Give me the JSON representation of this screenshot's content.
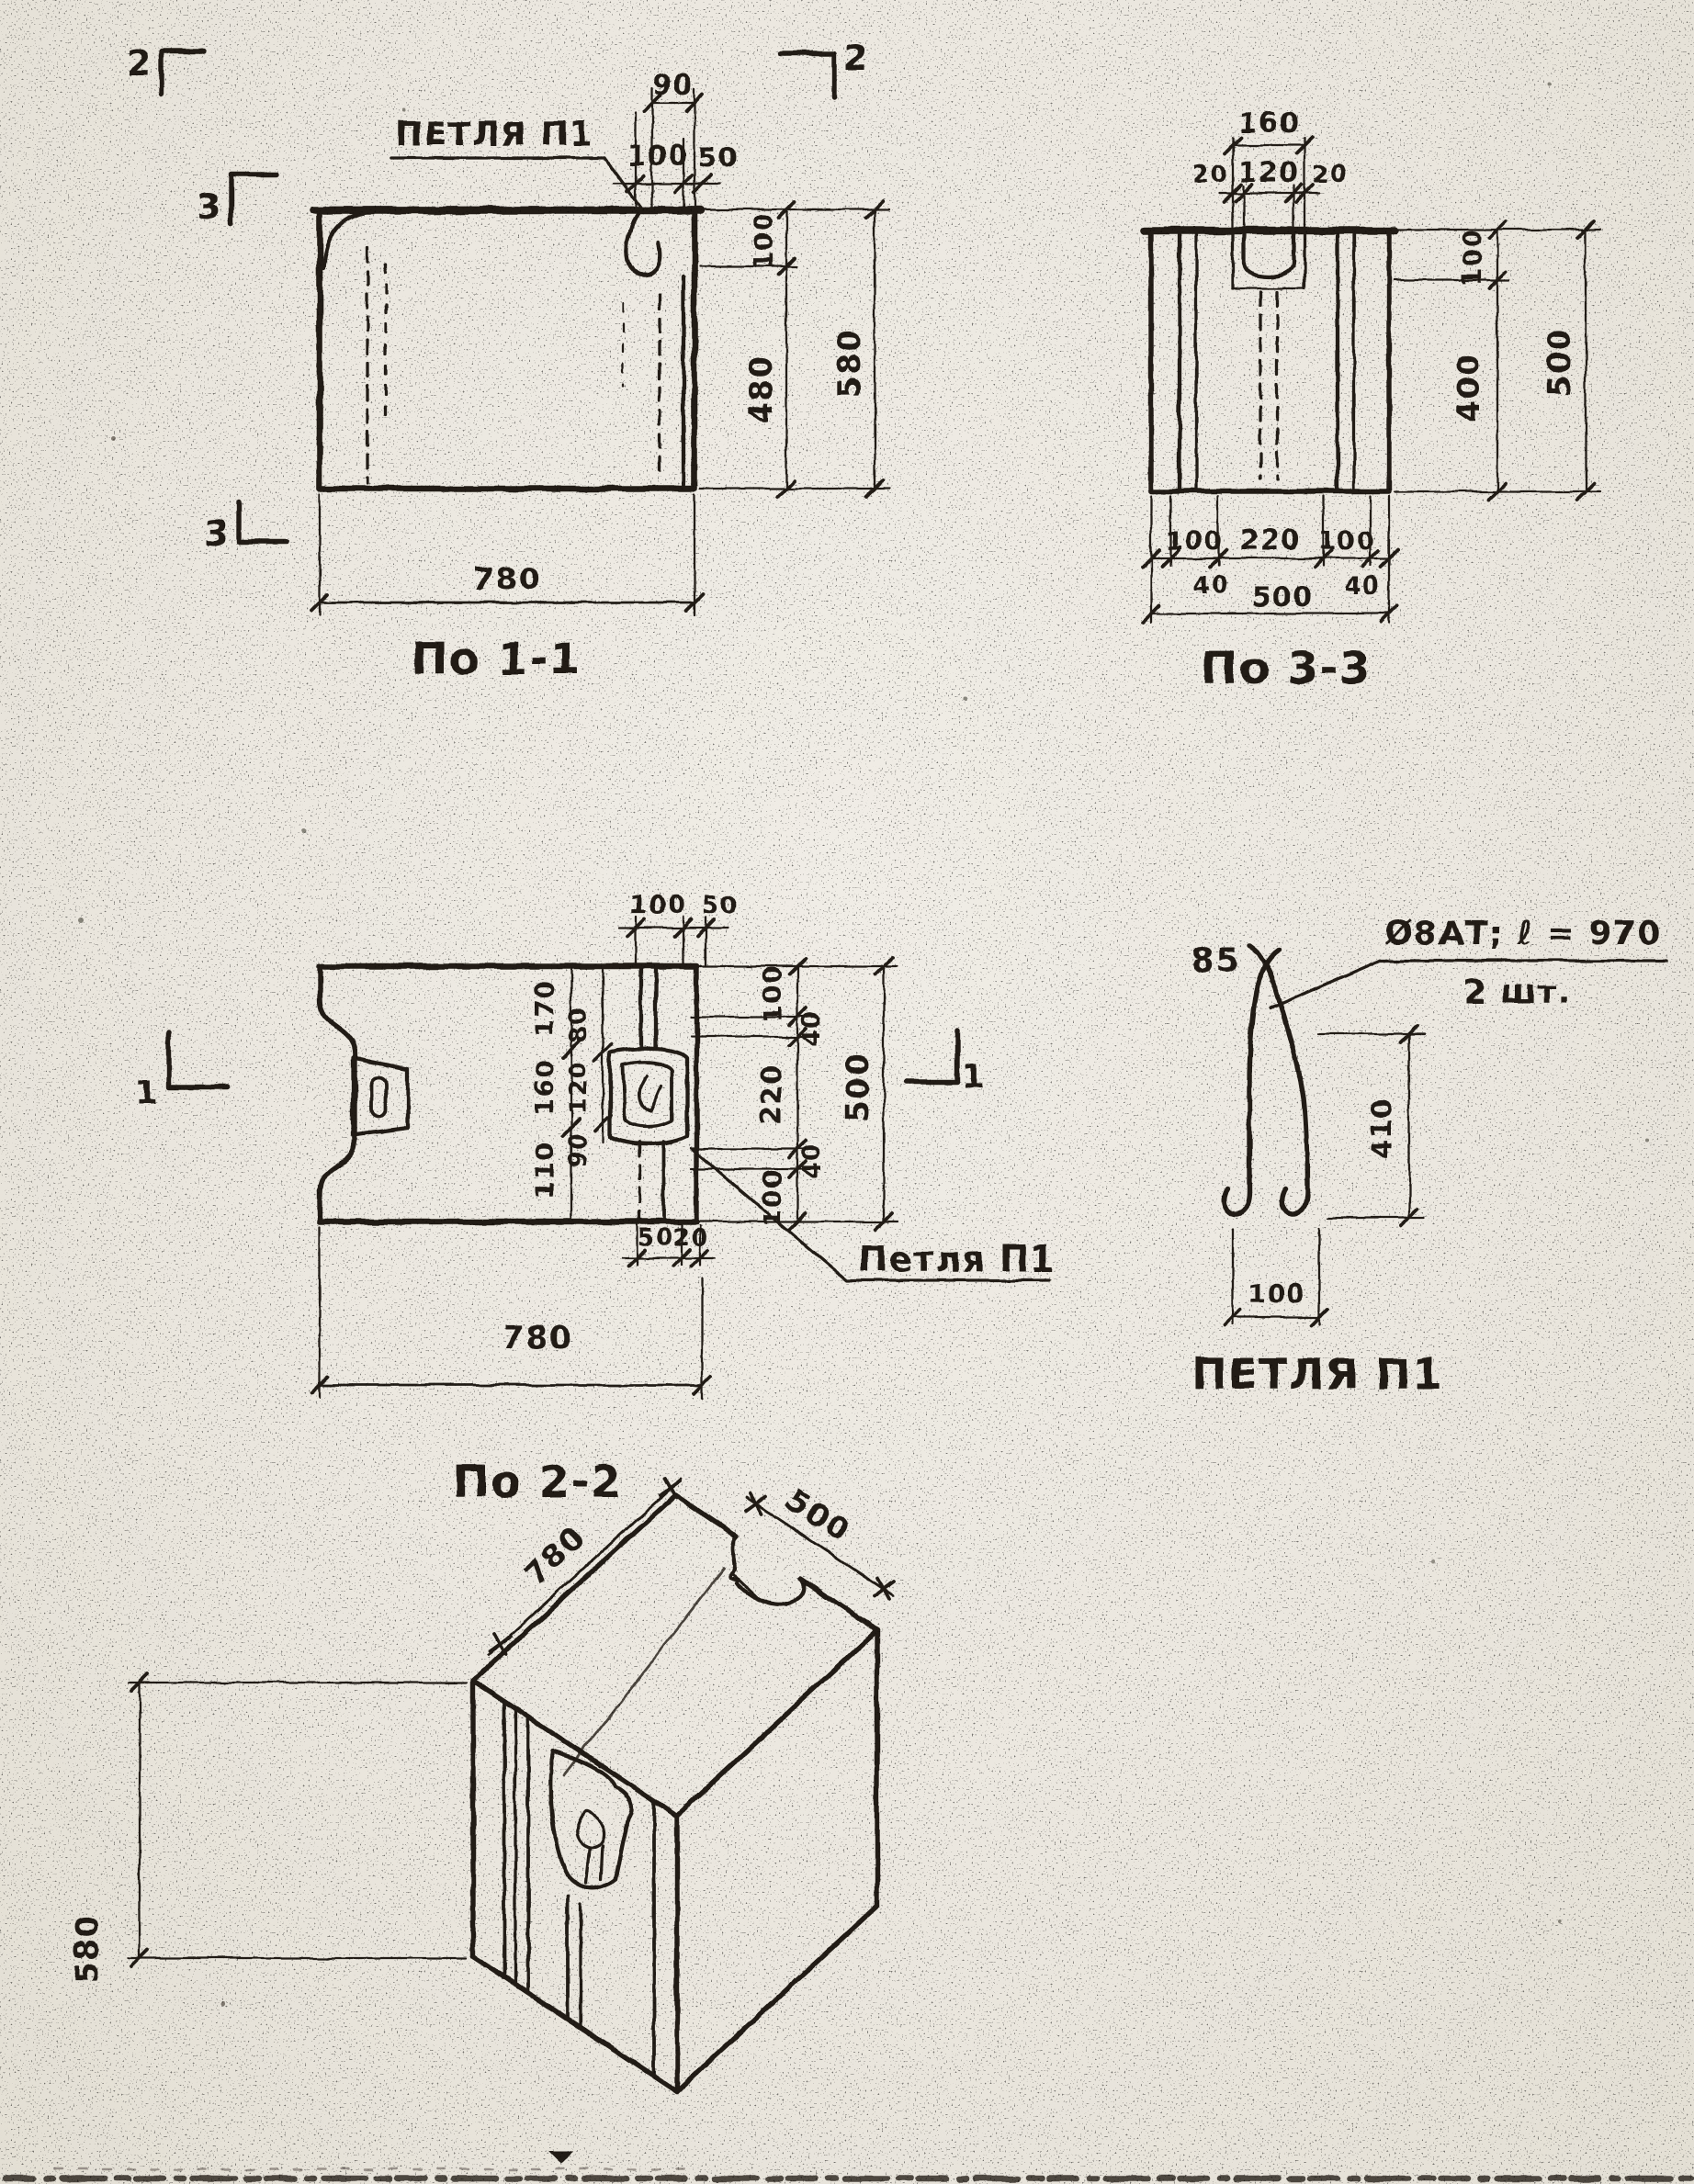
{
  "palette": {
    "paper": "#ebe7df",
    "ink": "#241f18"
  },
  "section_1_1": {
    "title": "По 1-1",
    "loop_callout": "ПЕТЛЯ П1",
    "marker_top_left": "2",
    "marker_top_right": "2",
    "marker_left": "3",
    "marker_bottom_left": "3",
    "dim_top_overall": "90",
    "dim_top_left": "100",
    "dim_top_right": "50",
    "dim_right_upper": "100",
    "dim_right_inner": "480",
    "dim_right_overall": "580",
    "dim_bottom": "780"
  },
  "section_3_3": {
    "title": "По 3-3",
    "dim_top_overall": "160",
    "dim_top_seg_left": "20",
    "dim_top_seg_mid": "120",
    "dim_top_seg_right": "20",
    "dim_right_upper": "100",
    "dim_right_inner": "400",
    "dim_right_overall": "500",
    "dim_bottom_seg_left": "100",
    "dim_bottom_seg_mid": "220",
    "dim_bottom_seg_right": "100",
    "dim_bottom_edge_left": "40",
    "dim_bottom_overall": "500",
    "dim_bottom_edge_right": "40"
  },
  "section_2_2": {
    "title": "По 2-2",
    "loop_callout": "Петля П1",
    "marker_left": "1",
    "marker_right": "1",
    "dim_top_left": "100",
    "dim_top_right": "50",
    "dims_col_outer": [
      "170",
      "160",
      "110"
    ],
    "dims_col_inner": [
      "80",
      "120",
      "90"
    ],
    "dims_right_chain": [
      "100",
      "40",
      "220",
      "40",
      "100"
    ],
    "dim_right_overall": "500",
    "dim_notch_a": "50",
    "dim_notch_b": "20",
    "dim_bottom": "780"
  },
  "loop_detail": {
    "title": "ПЕТЛЯ П1",
    "bend_mark": "85",
    "spec_line1": "Ø8АТ; ℓ = 970",
    "spec_line2": "2 шт.",
    "dim_height": "410",
    "dim_width": "100"
  },
  "isometric": {
    "dim_length": "780",
    "dim_depth": "500",
    "dim_height": "580"
  }
}
